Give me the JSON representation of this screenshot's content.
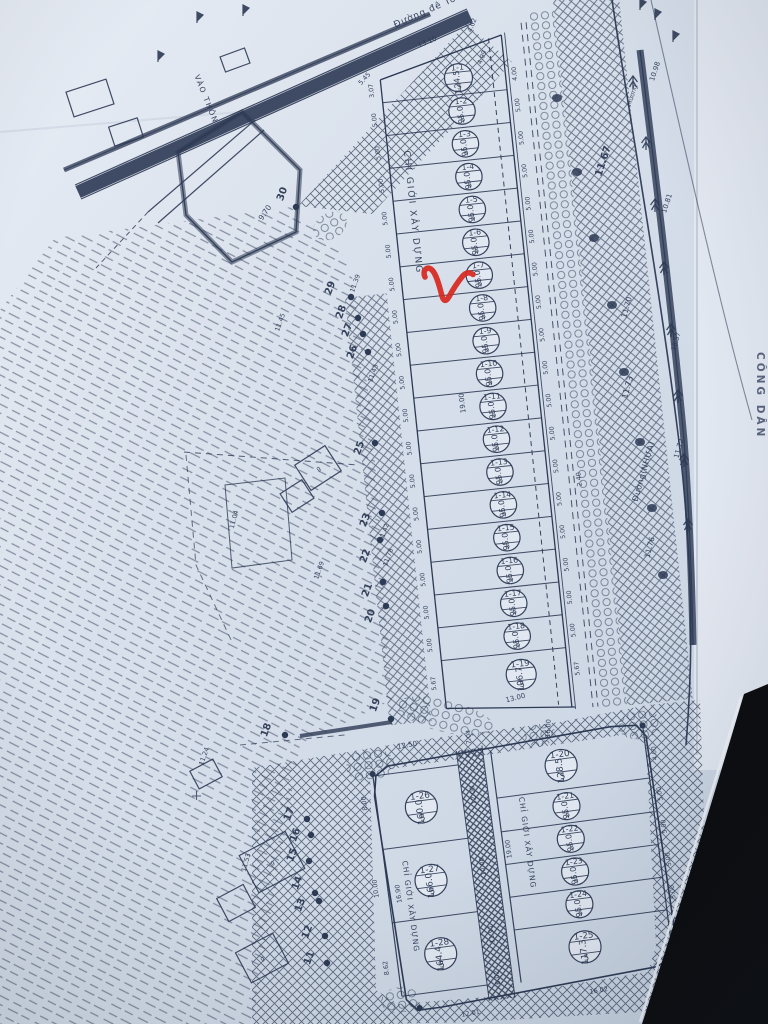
{
  "photo": {
    "paper_color": "#d8e0eb",
    "ink_color": "#2d3a54",
    "red_mark_color": "#d7261d",
    "background_color": "#0c0d10",
    "margin_color": "#e6ebf2"
  },
  "labels": {
    "dike_road": "Đường đê Tô",
    "right_road": "Đường(NHỰA)",
    "village_path": "VÀO THÔN",
    "canal": "Mương",
    "right_margin_vertical": "CÔNG DÂN",
    "setback": "CHỈ GIỚI XÂY DỰNG",
    "house_mark": "g"
  },
  "block1": {
    "plots": [
      {
        "id": "1-1",
        "area": "124.5",
        "w": "5"
      },
      {
        "id": "1-2",
        "area": "95.0",
        "w": "5"
      },
      {
        "id": "1-3",
        "area": "95.0",
        "w": "5"
      },
      {
        "id": "1-4",
        "area": "95.0",
        "w": "5"
      },
      {
        "id": "1-5",
        "area": "95.0",
        "w": "5"
      },
      {
        "id": "1-6",
        "area": "95.0",
        "w": "5"
      },
      {
        "id": "1-7",
        "area": "95.0",
        "w": "5"
      },
      {
        "id": "1-8",
        "area": "95.0",
        "w": "5"
      },
      {
        "id": "1-9",
        "area": "95.0",
        "w": "5"
      },
      {
        "id": "1-10",
        "area": "95.0",
        "w": "5"
      },
      {
        "id": "1-11",
        "area": "95.0",
        "w": "5"
      },
      {
        "id": "1-12",
        "area": "95.0",
        "w": "5"
      },
      {
        "id": "1-13",
        "area": "95.0",
        "w": "5"
      },
      {
        "id": "1-14",
        "area": "95.0",
        "w": "5"
      },
      {
        "id": "1-15",
        "area": "95.0",
        "w": "5"
      },
      {
        "id": "1-16",
        "area": "95.0",
        "w": "5"
      },
      {
        "id": "1-17",
        "area": "95.0",
        "w": "5"
      },
      {
        "id": "1-18",
        "area": "95.0",
        "w": "5"
      },
      {
        "id": "1-19",
        "area": "106.7",
        "w": "5"
      }
    ],
    "left_dims": [
      "3.07",
      "5.00",
      "5.00",
      "5.00",
      "5.00",
      "5.00",
      "5.00",
      "5.00",
      "5.00",
      "5.00",
      "5.00",
      "5.00",
      "5.00",
      "5.00",
      "5.00",
      "5.00",
      "5.00",
      "5.00",
      "5.67"
    ],
    "right_dims": [
      "4.00",
      "5.00",
      "5.00",
      "5.00",
      "5.00",
      "5.00",
      "5.00",
      "5.00",
      "5.00",
      "5.00",
      "5.00",
      "5.00",
      "5.00",
      "5.00",
      "5.00",
      "5.00",
      "5.00",
      "5.00",
      "5.67"
    ],
    "top_dims": [
      "13.10",
      "4.02",
      "4.99",
      "5.45"
    ],
    "bottom_dim": "13.00",
    "depth_dim": "19.00",
    "walkway_dim": "2.40"
  },
  "block2": {
    "left_plots": [
      {
        "id": "1-26",
        "area": "160.0",
        "w": "5"
      },
      {
        "id": "1-27",
        "area": "166.0",
        "w": "5"
      },
      {
        "id": "1-28",
        "area": "164.4",
        "w": "5"
      }
    ],
    "right_plots": [
      {
        "id": "1-20",
        "area": "128.5",
        "w": "5"
      },
      {
        "id": "1-21",
        "area": "95.0",
        "w": "5"
      },
      {
        "id": "1-22",
        "area": "95.0",
        "w": "5"
      },
      {
        "id": "1-23",
        "area": "95.0",
        "w": "5"
      },
      {
        "id": "1-24",
        "area": "95.0",
        "w": "5"
      },
      {
        "id": "1-25",
        "area": "117.3",
        "w": "5"
      }
    ],
    "right_edge_dims": [
      "4.00",
      "5.00",
      "5.00",
      "5.00",
      "5.00",
      "3.00"
    ],
    "dims": {
      "top_left": "12.50",
      "top_path": "7.04",
      "top_right": "16.00",
      "path_upper": "12.00",
      "path_middle": "10.00",
      "path_lower": "11.91",
      "path_bottom": "6.02",
      "right_depth": "19.00",
      "left_top": "8.00",
      "left_depth": "16.90",
      "left_middle": "10.00",
      "left_lower": "8.62",
      "bottom_left": "12.01",
      "bottom_right": "16.02"
    }
  },
  "survey_markers": [
    {
      "n": "30"
    },
    {
      "n": "29",
      "elev": "11.39"
    },
    {
      "n": "28"
    },
    {
      "n": "27"
    },
    {
      "n": "26",
      "elev": "11.43"
    },
    {
      "n": "25"
    },
    {
      "n": "23",
      "elev": "11.42"
    },
    {
      "n": "22",
      "elev": "11.78"
    },
    {
      "n": "21",
      "elev": "11.69"
    },
    {
      "n": "20"
    },
    {
      "n": "19"
    },
    {
      "n": "18"
    },
    {
      "n": "17"
    },
    {
      "n": "16"
    },
    {
      "n": "15"
    },
    {
      "n": "14"
    },
    {
      "n": "13"
    },
    {
      "n": "12"
    },
    {
      "n": "11"
    }
  ],
  "field_elevations": [
    {
      "v": "9.70"
    },
    {
      "v": "11.45"
    },
    {
      "v": "11.04"
    },
    {
      "v": "11.24"
    },
    {
      "v": "11.53"
    }
  ],
  "road_elevations": [
    {
      "v": "10.98"
    },
    {
      "v": "11.67"
    },
    {
      "v": "10.81"
    },
    {
      "v": "11.70"
    },
    {
      "v": "10.57"
    },
    {
      "v": "11.73"
    },
    {
      "v": "11.72"
    },
    {
      "v": "11.76"
    }
  ],
  "annotation": {
    "red_check_mark": "hand-drawn red check"
  }
}
